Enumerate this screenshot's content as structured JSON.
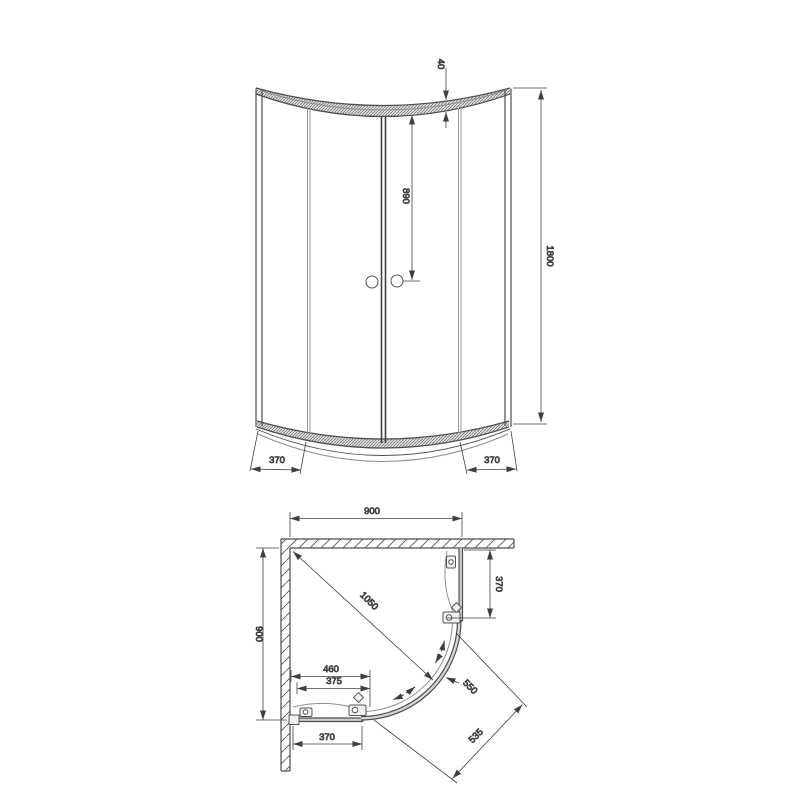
{
  "colors": {
    "background": "#ffffff",
    "outline": "#4d4d4d",
    "dimension_lines": "#3f3f3f",
    "glass": "#8f8f8f",
    "hatch": "#555555"
  },
  "front_view": {
    "dims": {
      "profile_height": "40",
      "handle_height": "890",
      "total_height": "1800",
      "left_panel": "370",
      "right_panel": "370"
    }
  },
  "plan_view": {
    "dims": {
      "width": "900",
      "depth": "900",
      "diagonal": "1050",
      "side_panel": "370",
      "door_width": "550",
      "radius": "535",
      "entry_outer": "460",
      "entry_inner": "375",
      "bottom_panel": "370"
    }
  }
}
